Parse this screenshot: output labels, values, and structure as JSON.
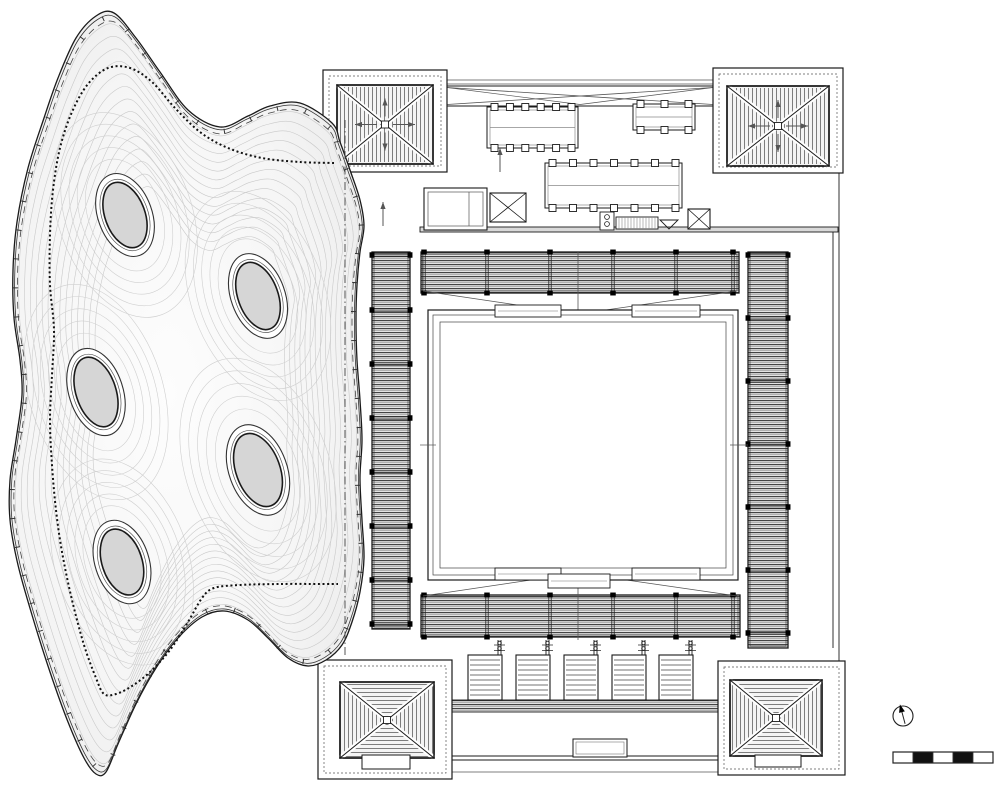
{
  "meta": {
    "drawing_type": "architectural-roof-plan",
    "visible_text": "none"
  },
  "colors": {
    "line": "#1a1a1a",
    "mid_line": "#555555",
    "light_line": "#c6c6c6",
    "contour": "#c9c9c9",
    "strip_fill": "#e3e3e3",
    "roof_fill": "#f4f4f4",
    "skylight_fill": "#d6d6d6",
    "blob_center": "#fdfdfd",
    "blob_edge": "#dedede",
    "black": "#111111",
    "white": "#ffffff"
  },
  "canopy": {
    "outline": [
      [
        332,
        123
      ],
      [
        300,
        103
      ],
      [
        270,
        106
      ],
      [
        248,
        116
      ],
      [
        220,
        127
      ],
      [
        188,
        110
      ],
      [
        160,
        72
      ],
      [
        136,
        38
      ],
      [
        114,
        13
      ],
      [
        96,
        16
      ],
      [
        76,
        38
      ],
      [
        58,
        78
      ],
      [
        44,
        118
      ],
      [
        28,
        168
      ],
      [
        17,
        222
      ],
      [
        13,
        270
      ],
      [
        14,
        318
      ],
      [
        20,
        360
      ],
      [
        22,
        395
      ],
      [
        16,
        440
      ],
      [
        10,
        480
      ],
      [
        10,
        520
      ],
      [
        18,
        565
      ],
      [
        32,
        615
      ],
      [
        50,
        672
      ],
      [
        68,
        722
      ],
      [
        84,
        758
      ],
      [
        96,
        774
      ],
      [
        106,
        772
      ],
      [
        118,
        744
      ],
      [
        136,
        704
      ],
      [
        156,
        668
      ],
      [
        178,
        638
      ],
      [
        202,
        617
      ],
      [
        224,
        611
      ],
      [
        248,
        620
      ],
      [
        268,
        638
      ],
      [
        288,
        658
      ],
      [
        308,
        666
      ],
      [
        326,
        660
      ],
      [
        342,
        645
      ],
      [
        352,
        622
      ],
      [
        360,
        592
      ],
      [
        364,
        558
      ],
      [
        362,
        520
      ],
      [
        360,
        478
      ],
      [
        362,
        440
      ],
      [
        360,
        400
      ],
      [
        357,
        360
      ],
      [
        356,
        320
      ],
      [
        357,
        285
      ],
      [
        360,
        252
      ],
      [
        364,
        226
      ],
      [
        360,
        200
      ],
      [
        350,
        170
      ],
      [
        340,
        142
      ]
    ],
    "inner_dotted": [
      [
        334,
        163
      ],
      [
        300,
        162
      ],
      [
        262,
        158
      ],
      [
        228,
        148
      ],
      [
        200,
        132
      ],
      [
        175,
        108
      ],
      [
        152,
        82
      ],
      [
        130,
        68
      ],
      [
        108,
        68
      ],
      [
        88,
        84
      ],
      [
        72,
        112
      ],
      [
        60,
        148
      ],
      [
        53,
        190
      ],
      [
        50,
        235
      ],
      [
        50,
        285
      ],
      [
        54,
        330
      ],
      [
        52,
        375
      ],
      [
        50,
        420
      ],
      [
        52,
        465
      ],
      [
        56,
        510
      ],
      [
        62,
        552
      ],
      [
        72,
        600
      ],
      [
        84,
        645
      ],
      [
        96,
        678
      ],
      [
        104,
        694
      ],
      [
        116,
        694
      ],
      [
        132,
        686
      ],
      [
        150,
        672
      ],
      [
        170,
        650
      ],
      [
        188,
        622
      ],
      [
        202,
        598
      ],
      [
        214,
        588
      ],
      [
        240,
        585
      ],
      [
        280,
        584
      ],
      [
        320,
        584
      ],
      [
        338,
        584
      ]
    ],
    "contour_levels": 14,
    "skylights": [
      {
        "cx": 125,
        "cy": 215,
        "rx": 20,
        "ry": 34,
        "ring_rx": 27,
        "ring_ry": 43,
        "rot": -20
      },
      {
        "cx": 258,
        "cy": 296,
        "rx": 20,
        "ry": 35,
        "ring_rx": 27,
        "ring_ry": 44,
        "rot": -20
      },
      {
        "cx": 96,
        "cy": 392,
        "rx": 20,
        "ry": 36,
        "ring_rx": 27,
        "ring_ry": 45,
        "rot": -18
      },
      {
        "cx": 258,
        "cy": 470,
        "rx": 22,
        "ry": 38,
        "ring_rx": 29,
        "ring_ry": 47,
        "rot": -20
      },
      {
        "cx": 122,
        "cy": 562,
        "rx": 20,
        "ry": 34,
        "ring_rx": 27,
        "ring_ry": 43,
        "rot": -18
      }
    ]
  },
  "building": {
    "hidden_wall": {
      "x": 345,
      "y1": 120,
      "y2": 655
    },
    "towers": [
      {
        "id": "top-left",
        "outer": [
          323,
          70,
          124,
          102
        ],
        "roof": [
          337,
          85,
          96,
          79
        ],
        "stripes": "vertical",
        "arrows": true,
        "hatch": null
      },
      {
        "id": "top-right",
        "outer": [
          713,
          68,
          130,
          105
        ],
        "roof": [
          727,
          86,
          102,
          80
        ],
        "stripes": "vertical",
        "arrows": true,
        "hatch": null
      },
      {
        "id": "bottom-left",
        "outer": [
          318,
          660,
          134,
          119
        ],
        "roof": [
          340,
          682,
          94,
          76
        ],
        "stripes": "quad",
        "arrows": false,
        "hatch": [
          362,
          755,
          48,
          14
        ]
      },
      {
        "id": "bottom-right",
        "outer": [
          718,
          661,
          127,
          114
        ],
        "roof": [
          730,
          680,
          92,
          76
        ],
        "stripes": "quad",
        "arrows": false,
        "hatch": [
          755,
          755,
          46,
          12
        ]
      }
    ],
    "parapet_lines": [
      [
        447,
        80,
        713,
        80
      ],
      [
        447,
        84,
        713,
        84
      ]
    ],
    "truss_band": [
      447,
      86,
      266,
      20
    ],
    "equipment_platforms": [
      {
        "rect": [
          487,
          107,
          91,
          41
        ],
        "pads": 6
      },
      {
        "rect": [
          633,
          104,
          62,
          26
        ],
        "pads": 3
      },
      {
        "rect": [
          545,
          163,
          137,
          45
        ],
        "pads": 7
      }
    ],
    "machine_room": [
      424,
      188,
      63,
      42
    ],
    "x_boxes": [
      [
        490,
        193,
        36,
        29
      ],
      [
        688,
        209,
        22,
        20
      ]
    ],
    "vent_box": [
      600,
      212,
      14,
      18
    ],
    "hatch_rect": [
      616,
      217,
      42,
      12
    ],
    "funnel": [
      660,
      220,
      18,
      9
    ],
    "arrows_up": [
      [
        445,
        125
      ],
      [
        500,
        160
      ],
      [
        718,
        116
      ],
      [
        383,
        214
      ]
    ],
    "wall_band": [
      420,
      227,
      418,
      5
    ],
    "right_wall_lines": [
      [
        839,
        173,
        839,
        661
      ],
      [
        833,
        230,
        833,
        648
      ]
    ],
    "strips": {
      "top": {
        "rect": [
          421,
          252,
          318,
          41
        ],
        "clips": [
          424,
          487,
          550,
          613,
          676,
          733
        ]
      },
      "bottom": {
        "rect": [
          421,
          595,
          319,
          42
        ],
        "clips": [
          424,
          487,
          550,
          613,
          676,
          733
        ]
      },
      "left": {
        "rect": [
          372,
          252,
          38,
          377
        ],
        "clips": [
          255,
          310,
          364,
          418,
          472,
          526,
          580,
          624
        ]
      },
      "right": {
        "rect": [
          748,
          252,
          40,
          396
        ],
        "clips": [
          255,
          318,
          381,
          444,
          507,
          570,
          633
        ]
      }
    },
    "valley": {
      "left_x": 423,
      "right_x": 737,
      "center_x": 578,
      "top_y": 291,
      "top_apex_y": 314,
      "bottom_y": 596,
      "bottom_apex_y": 573
    },
    "courtyard": {
      "outer": [
        428,
        310,
        310,
        270
      ],
      "mid": [
        433,
        315,
        300,
        260
      ],
      "inner": [
        440,
        322,
        286,
        246
      ],
      "tabs": [
        [
          495,
          305,
          66,
          12
        ],
        [
          632,
          305,
          68,
          12
        ],
        [
          495,
          568,
          66,
          12
        ],
        [
          632,
          568,
          68,
          12
        ],
        [
          548,
          574,
          62,
          14
        ]
      ]
    },
    "bottom_wing": {
      "band": [
        452,
        700,
        266,
        12
      ],
      "wall_y1": 756,
      "wall_y2": 760,
      "outer_y": 772,
      "span": [
        452,
        718
      ],
      "center_rect": [
        573,
        739,
        54,
        18
      ]
    },
    "louver_panels": {
      "y": 655,
      "w": 34,
      "h": 45,
      "xs": [
        468,
        516,
        564,
        612,
        659
      ]
    }
  },
  "symbols": {
    "north_arrow": {
      "cx": 903,
      "cy": 716,
      "r": 10,
      "rotation_deg": -15
    },
    "scale_bar": {
      "x": 893,
      "y": 752,
      "w": 100,
      "h": 11,
      "segments": [
        "white",
        "black",
        "white",
        "black",
        "white"
      ]
    }
  }
}
